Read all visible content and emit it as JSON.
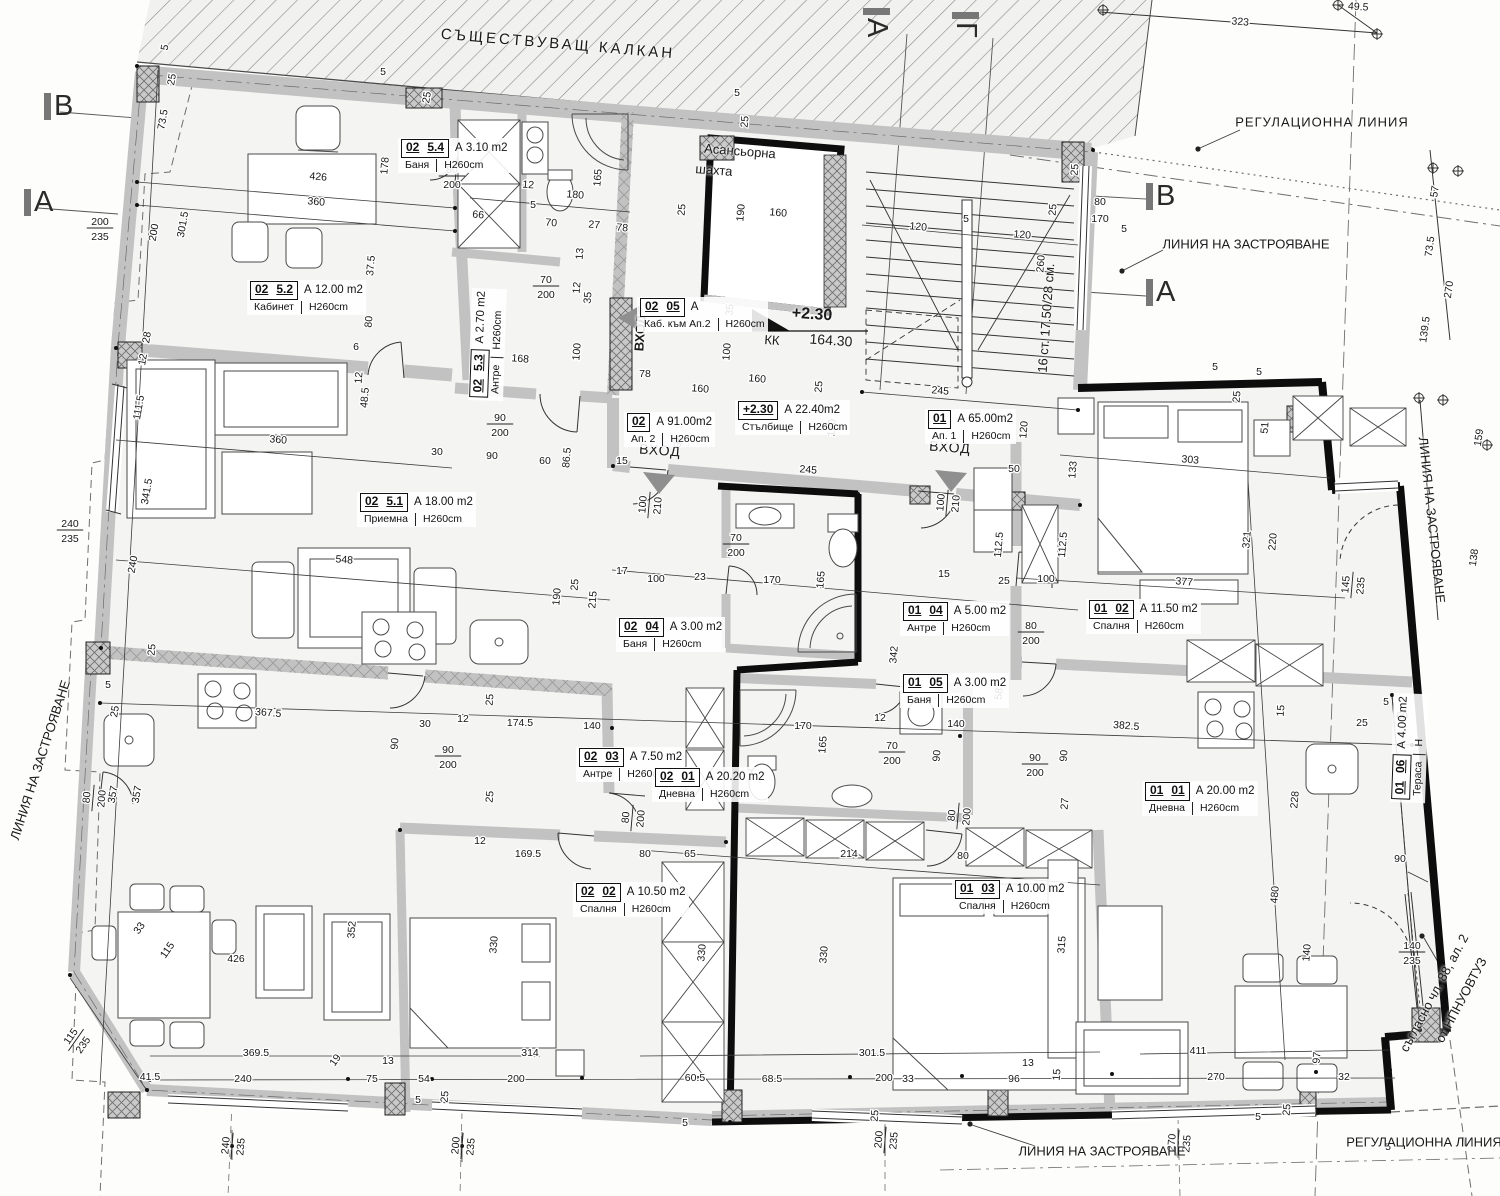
{
  "page_title": "Етажен план — кота +2.30",
  "colors": {
    "wall_grey": "#c2c2c2",
    "heavy_black": "#0d0d0d",
    "floor": "#f4f4f2",
    "hatch": "#8a8a8a",
    "accent_grey": "#777777"
  },
  "level_mark": {
    "value": "+2.30",
    "kk_label": "КК",
    "kk_value": "164.30"
  },
  "elevator": {
    "line1": "Асансьорна",
    "line2": "шахта"
  },
  "stairs_note": "16 ст. 17.50/28 см.",
  "annotations": [
    {
      "t": "СЪЩЕСТВУВАЩ КАЛКАН",
      "x": 558,
      "y": 44,
      "r": 4.8,
      "s": 15,
      "ls": 3
    },
    {
      "t": "РЕГУЛАЦИОННА ЛИНИЯ",
      "x": 1322,
      "y": 122,
      "r": 0,
      "s": 13,
      "ls": 1
    },
    {
      "t": "ЛИНИЯ НА ЗАСТРОЯВАНЕ",
      "x": 1246,
      "y": 244,
      "r": 0,
      "s": 13,
      "ls": 0
    },
    {
      "t": "Асансьорна",
      "x": 740,
      "y": 151,
      "r": 4.5,
      "s": 13,
      "ls": 0
    },
    {
      "t": "шахта",
      "x": 714,
      "y": 170,
      "r": 4.5,
      "s": 13,
      "ls": 0
    },
    {
      "t": "16 ст. 17.50/28 см.",
      "x": 1046,
      "y": 318,
      "r": -86,
      "s": 13,
      "ls": 0
    },
    {
      "t": "ВХОД",
      "x": 640,
      "y": 333,
      "r": -86,
      "s": 13,
      "b": 1,
      "ls": 0
    },
    {
      "t": "ВХОД",
      "x": 660,
      "y": 450,
      "r": 4,
      "s": 14,
      "b": 0,
      "ls": 1
    },
    {
      "t": "ВХОД",
      "x": 950,
      "y": 447,
      "r": 4,
      "s": 14,
      "b": 0,
      "ls": 1
    },
    {
      "t": "ЛИНИЯ НА ЗАСТРОЯВАНЕ",
      "x": 40,
      "y": 760,
      "r": -72,
      "s": 13,
      "ls": 0
    },
    {
      "t": "ЛИНИЯ НА ЗАСТРОЯВАНЕ",
      "x": 1432,
      "y": 520,
      "r": 84,
      "s": 13,
      "ls": 0
    },
    {
      "t": "ЛИНИЯ НА ЗАСТРОЯВАНЕ",
      "x": 1102,
      "y": 1151,
      "r": 0,
      "s": 13,
      "ls": 0
    },
    {
      "t": "РЕГУЛАЦИОННА ЛИНИЯ",
      "x": 1424,
      "y": 1142,
      "r": 0,
      "s": 13,
      "ls": 0
    },
    {
      "t": "съгласно чл. 88, ал. 2",
      "x": 1434,
      "y": 993,
      "r": -62,
      "s": 13,
      "ls": 0
    },
    {
      "t": "от НПНУОВТУЗ",
      "x": 1461,
      "y": 1000,
      "r": -62,
      "s": 13,
      "ls": 0
    },
    {
      "t": "+2.30",
      "x": 812,
      "y": 315,
      "r": 4,
      "s": 16,
      "b": 1,
      "ls": 0
    },
    {
      "t": "КК",
      "x": 772,
      "y": 340,
      "r": 4,
      "s": 13,
      "ls": 0
    },
    {
      "t": "164.30",
      "x": 831,
      "y": 340,
      "r": 4,
      "s": 14,
      "ls": 0
    }
  ],
  "section_markers": [
    {
      "t": "В",
      "x": 44,
      "y": 90,
      "r": 0
    },
    {
      "t": "А",
      "x": 24,
      "y": 186,
      "r": 0
    },
    {
      "t": "В",
      "x": 1146,
      "y": 180,
      "r": 0
    },
    {
      "t": "А",
      "x": 1146,
      "y": 276,
      "r": 0
    },
    {
      "t": "А",
      "x": 893,
      "y": 8,
      "r": 90
    },
    {
      "t": "Г",
      "x": 982,
      "y": 12,
      "r": 90
    }
  ],
  "rooms": [
    {
      "cells": [
        "02",
        "5.4"
      ],
      "area": "А 3.10 m2",
      "name": "Баня",
      "h": "Н260cm",
      "x": 398,
      "y": 138,
      "r": 0
    },
    {
      "cells": [
        "02",
        "5.2"
      ],
      "area": "А 12.00 m2",
      "name": "Кабинет",
      "h": "Н260cm",
      "x": 247,
      "y": 280,
      "r": 0
    },
    {
      "cells": [
        "02",
        "5.3"
      ],
      "area": "А 2.70 m2",
      "name": "Антре",
      "h": "Н260cm",
      "x": 468,
      "y": 400,
      "r": -88
    },
    {
      "cells": [
        "02",
        "5.1"
      ],
      "area": "А 18.00 m2",
      "name": "Приемна",
      "h": "Н260cm",
      "x": 357,
      "y": 492,
      "r": 0
    },
    {
      "cells": [
        "02",
        "05"
      ],
      "area": "А",
      "name": "Каб. към Ап.2",
      "h": "Н260cm",
      "x": 637,
      "y": 297,
      "r": 0
    },
    {
      "cells": [
        "+2.30"
      ],
      "area": "А 22.40m2",
      "name": "Стълбище",
      "h": "Н260cm",
      "x": 735,
      "y": 400,
      "r": 0
    },
    {
      "cells": [
        "02"
      ],
      "area": "А 91.00m2",
      "name": "Ап. 2",
      "h": "Н260cm",
      "x": 624,
      "y": 412,
      "r": 0
    },
    {
      "cells": [
        "01"
      ],
      "area": "А 65.00m2",
      "name": "Ап. 1",
      "h": "Н260cm",
      "x": 925,
      "y": 409,
      "r": 0
    },
    {
      "cells": [
        "02",
        "04"
      ],
      "area": "А 3.00 m2",
      "name": "Баня",
      "h": "Н260cm",
      "x": 616,
      "y": 617,
      "r": 0
    },
    {
      "cells": [
        "01",
        "04"
      ],
      "area": "А 5.00 m2",
      "name": "Антре",
      "h": "Н260cm",
      "x": 900,
      "y": 601,
      "r": 0
    },
    {
      "cells": [
        "01",
        "05"
      ],
      "area": "А 3.00 m2",
      "name": "Баня",
      "h": "Н260cm",
      "x": 900,
      "y": 673,
      "r": 0
    },
    {
      "cells": [
        "01",
        "02"
      ],
      "area": "А 11.50 m2",
      "name": "Спалня",
      "h": "Н260cm",
      "x": 1086,
      "y": 599,
      "r": 0
    },
    {
      "cells": [
        "02",
        "03"
      ],
      "area": "А 7.50 m2",
      "name": "Антре",
      "h": "Н260cm",
      "x": 576,
      "y": 747,
      "r": 0
    },
    {
      "cells": [
        "02",
        "01"
      ],
      "area": "А 20.20 m2",
      "name": "Дневна",
      "h": "Н260cm",
      "x": 652,
      "y": 767,
      "r": 0
    },
    {
      "cells": [
        "01",
        "01"
      ],
      "area": "А 20.00 m2",
      "name": "Дневна",
      "h": "Н260cm",
      "x": 1142,
      "y": 781,
      "r": 0
    },
    {
      "cells": [
        "02",
        "02"
      ],
      "area": "А 10.50 m2",
      "name": "Спалня",
      "h": "Н260cm",
      "x": 573,
      "y": 882,
      "r": 0
    },
    {
      "cells": [
        "01",
        "03"
      ],
      "area": "А 10.00 m2",
      "name": "Спалня",
      "h": "Н260cm",
      "x": 952,
      "y": 879,
      "r": 0
    },
    {
      "cells": [
        "01",
        "06"
      ],
      "area": "А 4.00 m2",
      "name": "Тераса",
      "h": "Н",
      "x": 1390,
      "y": 802,
      "r": -88
    }
  ],
  "dims": [
    [
      "5",
      168,
      48,
      -80
    ],
    [
      "25",
      175,
      80,
      -80
    ],
    [
      "73.5",
      166,
      120,
      -80
    ],
    [
      "301.5",
      186,
      225,
      -80
    ],
    [
      "200",
      157,
      233,
      -80
    ],
    [
      "28",
      150,
      338,
      -80
    ],
    [
      "12",
      146,
      360,
      -80
    ],
    [
      "111.5",
      142,
      408,
      -80
    ],
    [
      "341.5",
      150,
      492,
      -80
    ],
    [
      "240",
      136,
      565,
      -80
    ],
    [
      "5",
      108,
      688,
      0
    ],
    [
      "25",
      118,
      712,
      -80
    ],
    [
      "357",
      116,
      795,
      -80
    ],
    [
      "357",
      140,
      795,
      -80
    ],
    [
      "33",
      142,
      930,
      -55
    ],
    [
      "115",
      170,
      952,
      -55
    ],
    [
      "19",
      338,
      1062,
      -55
    ],
    [
      "5",
      383,
      75,
      0
    ],
    [
      "25",
      430,
      98,
      -80
    ],
    [
      "426",
      318,
      180,
      4.5
    ],
    [
      "360",
      316,
      205,
      4.5
    ],
    [
      "178",
      388,
      166,
      -85
    ],
    [
      "37.5",
      374,
      266,
      -85
    ],
    [
      "80",
      372,
      322,
      -85
    ],
    [
      "6",
      356,
      350,
      0
    ],
    [
      "12",
      362,
      378,
      -85
    ],
    [
      "48.5",
      368,
      398,
      -85
    ],
    [
      "360",
      278,
      443,
      4.5
    ],
    [
      "66",
      478,
      218,
      4.5
    ],
    [
      "12",
      528,
      188,
      4.5
    ],
    [
      "5",
      533,
      208,
      0
    ],
    [
      "70",
      551,
      226,
      4.5
    ],
    [
      "27",
      594,
      228,
      4.5
    ],
    [
      "78",
      622,
      231,
      4.5
    ],
    [
      "180",
      575,
      198,
      4.5
    ],
    [
      "165",
      601,
      178,
      -85
    ],
    [
      "13",
      583,
      254,
      -85
    ],
    [
      "12",
      580,
      288,
      -85
    ],
    [
      "35",
      591,
      298,
      -85
    ],
    [
      "100",
      580,
      352,
      -85
    ],
    [
      "168",
      520,
      362,
      4.5
    ],
    [
      "78",
      645,
      377,
      0
    ],
    [
      "5",
      737,
      96,
      0
    ],
    [
      "25",
      748,
      122,
      -85
    ],
    [
      "190",
      744,
      213,
      -85
    ],
    [
      "160",
      778,
      216,
      4.5
    ],
    [
      "25",
      685,
      210,
      -85
    ],
    [
      "160",
      700,
      392,
      4.5
    ],
    [
      "35",
      733,
      310,
      -85
    ],
    [
      "100",
      730,
      352,
      -85
    ],
    [
      "160",
      757,
      382,
      4.5
    ],
    [
      "25",
      822,
      387,
      -85
    ],
    [
      "120",
      918,
      230,
      4.5
    ],
    [
      "5",
      966,
      222,
      0
    ],
    [
      "120",
      1022,
      238,
      4.5
    ],
    [
      "25",
      1056,
      210,
      -85
    ],
    [
      "260",
      1044,
      264,
      -85
    ],
    [
      "80",
      1100,
      205,
      0
    ],
    [
      "170",
      1100,
      222,
      0
    ],
    [
      "5",
      1124,
      232,
      0
    ],
    [
      "25",
      1078,
      170,
      -85
    ],
    [
      "245",
      940,
      394,
      4.5
    ],
    [
      "49.5",
      1358,
      10,
      4
    ],
    [
      "323",
      1240,
      25,
      4
    ],
    [
      "57",
      1438,
      192,
      -82
    ],
    [
      "73.5",
      1433,
      247,
      -82
    ],
    [
      "270",
      1452,
      290,
      -82
    ],
    [
      "139.5",
      1428,
      330,
      -82
    ],
    [
      "30",
      437,
      455,
      0
    ],
    [
      "90",
      492,
      459,
      0
    ],
    [
      "60",
      545,
      464,
      0
    ],
    [
      "86.5",
      570,
      458,
      -85
    ],
    [
      "97",
      681,
      442,
      -85
    ],
    [
      "15",
      622,
      464,
      0
    ],
    [
      "50",
      1014,
      472,
      0
    ],
    [
      "245",
      808,
      473,
      4.5
    ],
    [
      "120",
      835,
      428,
      -85
    ],
    [
      "120",
      1027,
      430,
      -85
    ],
    [
      "17",
      622,
      574,
      0
    ],
    [
      "100",
      656,
      582,
      0
    ],
    [
      "23",
      700,
      580,
      0
    ],
    [
      "170",
      772,
      583,
      0
    ],
    [
      "165",
      824,
      580,
      -85
    ],
    [
      "15",
      944,
      577,
      0
    ],
    [
      "100",
      1046,
      582,
      0
    ],
    [
      "25",
      1004,
      584,
      0
    ],
    [
      "112.5",
      1002,
      545,
      -85
    ],
    [
      "112.5",
      1066,
      545,
      -85
    ],
    [
      "5",
      1215,
      370,
      0
    ],
    [
      "5",
      1259,
      375,
      0
    ],
    [
      "25",
      1240,
      397,
      -85
    ],
    [
      "51",
      1268,
      428,
      -85
    ],
    [
      "133",
      1076,
      470,
      -85
    ],
    [
      "303",
      1190,
      463,
      4.5
    ],
    [
      "321",
      1250,
      540,
      -85
    ],
    [
      "220",
      1276,
      542,
      -85
    ],
    [
      "377",
      1184,
      585,
      4.5
    ],
    [
      "159",
      1482,
      438,
      -82
    ],
    [
      "138",
      1477,
      558,
      -82
    ],
    [
      "548",
      344,
      563,
      4.5
    ],
    [
      "190",
      560,
      597,
      -85
    ],
    [
      "215",
      596,
      600,
      -85
    ],
    [
      "25",
      578,
      585,
      -85
    ],
    [
      "367.5",
      268,
      716,
      4.5
    ],
    [
      "25",
      155,
      650,
      -85
    ],
    [
      "30",
      425,
      727,
      0
    ],
    [
      "90",
      398,
      744,
      -85
    ],
    [
      "12",
      463,
      722,
      0
    ],
    [
      "174.5",
      520,
      726,
      0
    ],
    [
      "140",
      592,
      729,
      0
    ],
    [
      "25",
      493,
      700,
      -85
    ],
    [
      "25",
      493,
      797,
      -85
    ],
    [
      "170",
      803,
      729,
      0
    ],
    [
      "165",
      826,
      745,
      -85
    ],
    [
      "12",
      880,
      721,
      0
    ],
    [
      "342",
      897,
      655,
      -85
    ],
    [
      "58",
      1002,
      694,
      -85
    ],
    [
      "140",
      956,
      727,
      0
    ],
    [
      "90",
      940,
      756,
      -85
    ],
    [
      "90",
      1067,
      756,
      -85
    ],
    [
      "27",
      1068,
      804,
      -85
    ],
    [
      "382.5",
      1126,
      729,
      4.5
    ],
    [
      "15",
      1284,
      711,
      -85
    ],
    [
      "5",
      1386,
      705,
      0
    ],
    [
      "25",
      1362,
      726,
      0
    ],
    [
      "60",
      1402,
      719,
      0
    ],
    [
      "169.5",
      528,
      857,
      0
    ],
    [
      "12",
      480,
      844,
      0
    ],
    [
      "80",
      645,
      857,
      0
    ],
    [
      "65",
      690,
      857,
      0
    ],
    [
      "214",
      849,
      857,
      0
    ],
    [
      "80",
      963,
      859,
      0
    ],
    [
      "352",
      355,
      930,
      -85
    ],
    [
      "330",
      497,
      945,
      -85
    ],
    [
      "330",
      705,
      953,
      -85
    ],
    [
      "330",
      827,
      955,
      -85
    ],
    [
      "315",
      1065,
      945,
      -85
    ],
    [
      "480",
      1278,
      895,
      -85
    ],
    [
      "140",
      1310,
      953,
      -85
    ],
    [
      "97",
      1320,
      1058,
      -85
    ],
    [
      "228",
      1298,
      800,
      -85
    ],
    [
      "90",
      1400,
      862,
      0
    ],
    [
      "426",
      236,
      962,
      0
    ],
    [
      "369.5",
      256,
      1056,
      0
    ],
    [
      "314",
      530,
      1056,
      0
    ],
    [
      "301.5",
      872,
      1056,
      0
    ],
    [
      "411",
      1198,
      1054,
      0
    ],
    [
      "41.5",
      150,
      1080,
      0
    ],
    [
      "240",
      243,
      1082,
      0
    ],
    [
      "75",
      372,
      1082,
      0
    ],
    [
      "13",
      388,
      1064,
      0
    ],
    [
      "54",
      424,
      1082,
      0
    ],
    [
      "200",
      516,
      1082,
      0
    ],
    [
      "60.5",
      695,
      1081,
      0
    ],
    [
      "68.5",
      772,
      1082,
      0
    ],
    [
      "200",
      884,
      1081,
      0
    ],
    [
      "33",
      908,
      1082,
      0
    ],
    [
      "96",
      1014,
      1082,
      0
    ],
    [
      "13",
      1028,
      1066,
      0
    ],
    [
      "270",
      1216,
      1080,
      0
    ],
    [
      "32",
      1344,
      1080,
      0
    ],
    [
      "5",
      418,
      1103,
      0
    ],
    [
      "25",
      448,
      1097,
      -85
    ],
    [
      "5",
      685,
      1126,
      0
    ],
    [
      "25",
      878,
      1116,
      -85
    ],
    [
      "15",
      1060,
      1075,
      -85
    ],
    [
      "25",
      1290,
      1110,
      -85
    ],
    [
      "5",
      1258,
      1120,
      0
    ],
    [
      "5",
      1388,
      1150,
      0
    ]
  ],
  "frac_dims": [
    [
      "200",
      "235",
      100,
      228,
      0
    ],
    [
      "240",
      "235",
      70,
      530,
      0
    ],
    [
      "80",
      "200",
      452,
      176,
      0
    ],
    [
      "70",
      "200",
      546,
      286,
      0
    ],
    [
      "90",
      "200",
      500,
      424,
      0
    ],
    [
      "80",
      "200",
      93,
      798,
      -85
    ],
    [
      "100",
      "210",
      649,
      505,
      -85
    ],
    [
      "100",
      "210",
      947,
      503,
      -85
    ],
    [
      "70",
      "200",
      736,
      544,
      0
    ],
    [
      "70",
      "200",
      892,
      752,
      0
    ],
    [
      "80",
      "200",
      1031,
      632,
      0
    ],
    [
      "90",
      "200",
      448,
      756,
      0
    ],
    [
      "90",
      "200",
      1035,
      764,
      0
    ],
    [
      "80",
      "200",
      632,
      818,
      -85
    ],
    [
      "80",
      "200",
      958,
      816,
      -85
    ],
    [
      "145",
      "235",
      1352,
      585,
      -85
    ],
    [
      "140",
      "235",
      1412,
      952,
      0
    ],
    [
      "115",
      "235",
      76,
      1040,
      -55
    ],
    [
      "240",
      "235",
      232,
      1146,
      -85
    ],
    [
      "200",
      "235",
      462,
      1146,
      -85
    ],
    [
      "200",
      "235",
      885,
      1140,
      -85
    ],
    [
      "270",
      "235",
      1178,
      1143,
      -85
    ]
  ]
}
